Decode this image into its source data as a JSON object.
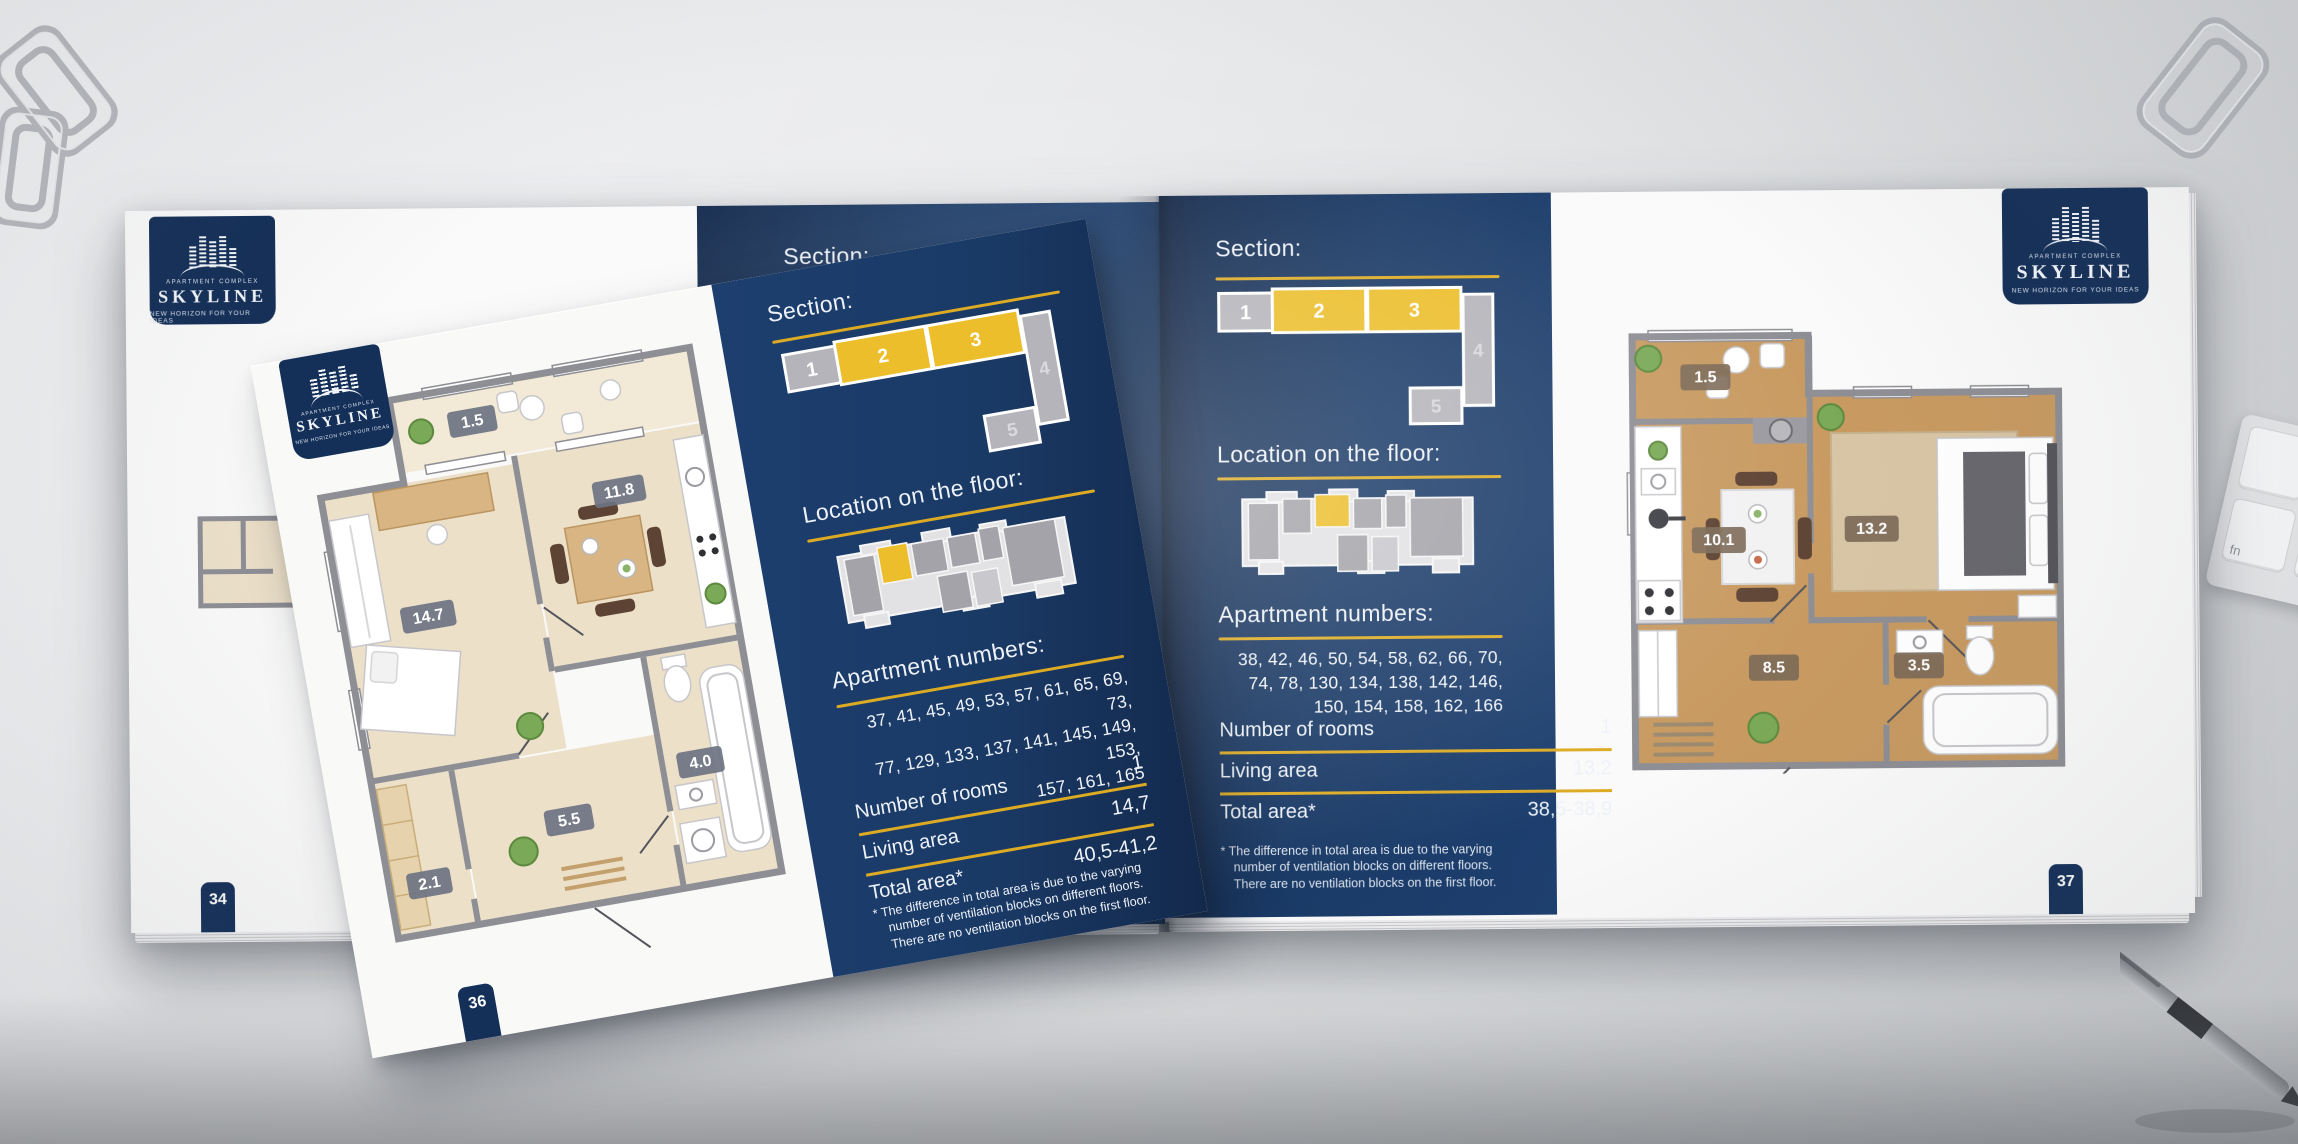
{
  "brand": {
    "complex_label": "APARTMENT COMPLEX",
    "name": "SKYLINE",
    "tagline": "NEW HORIZON FOR YOUR IDEAS"
  },
  "left_page": {
    "page_number": "34",
    "section_heading": "Section:"
  },
  "overlay_page": {
    "page_number": "36",
    "section_heading": "Section:",
    "section_blocks": [
      {
        "label": "1",
        "highlighted": false
      },
      {
        "label": "2",
        "highlighted": true
      },
      {
        "label": "3",
        "highlighted": true
      },
      {
        "label": "4",
        "highlighted": false
      },
      {
        "label": "5",
        "highlighted": false
      }
    ],
    "location_heading": "Location on the floor:",
    "apartment_numbers_heading": "Apartment numbers:",
    "apartment_numbers_lines": [
      "37, 41, 45, 49, 53, 57, 61, 65, 69, 73,",
      "77, 129, 133, 137, 141, 145, 149, 153,",
      "157, 161, 165"
    ],
    "stats": [
      {
        "label": "Number of rooms",
        "value": "1"
      },
      {
        "label": "Living area",
        "value": "14,7"
      },
      {
        "label": "Total area*",
        "value": "40,5-41,2"
      }
    ],
    "footnote": "* The difference in total area is due to the varying number of ventilation blocks on different floors. There are no ventilation blocks on the first floor.",
    "room_areas": {
      "balcony": "1.5",
      "living_room": "14.7",
      "kitchen": "11.8",
      "hallway": "5.5",
      "storage": "2.1",
      "bathroom": "4.0"
    }
  },
  "right_page": {
    "page_number": "37",
    "section_heading": "Section:",
    "section_blocks": [
      {
        "label": "1",
        "highlighted": false
      },
      {
        "label": "2",
        "highlighted": true
      },
      {
        "label": "3",
        "highlighted": true
      },
      {
        "label": "4",
        "highlighted": false
      },
      {
        "label": "5",
        "highlighted": false
      }
    ],
    "location_heading": "Location on the floor:",
    "apartment_numbers_heading": "Apartment numbers:",
    "apartment_numbers_lines": [
      "38, 42, 46, 50, 54, 58, 62, 66, 70,",
      "74, 78, 130, 134, 138, 142, 146,",
      "150, 154, 158, 162, 166"
    ],
    "stats": [
      {
        "label": "Number of rooms",
        "value": "1"
      },
      {
        "label": "Living area",
        "value": "13,2"
      },
      {
        "label": "Total area*",
        "value": "38,5-38,9"
      }
    ],
    "footnote": "* The difference in total area is due to the varying number of ventilation blocks on different floors. There are no ventilation blocks on the first floor.",
    "room_areas": {
      "balcony": "1.5",
      "kitchen": "10.1",
      "bedroom": "13.2",
      "hallway": "8.5",
      "bathroom": "3.5"
    }
  },
  "decorations": {
    "keyboard_key_label": "fn"
  },
  "colors": {
    "navy": "#16345e",
    "gold": "#ddab23",
    "highlight_yellow": "#ecbe2b",
    "block_gray": "#b5b4ba",
    "page_white": "#fafafa"
  }
}
